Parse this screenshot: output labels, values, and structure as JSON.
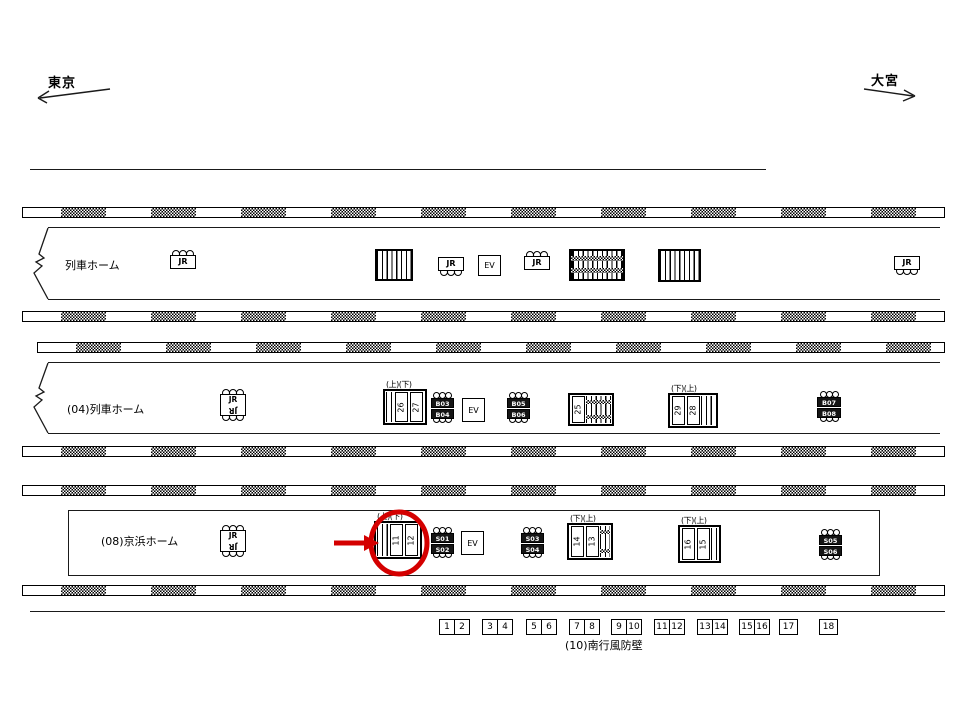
{
  "direction_labels": {
    "left": "東京",
    "right": "大宮"
  },
  "platforms": [
    {
      "name": "upper-platform",
      "label": "列車ホーム",
      "items": [
        {
          "type": "jr",
          "variant": "top",
          "label": "JR",
          "x": 170,
          "y": 250,
          "w": 26,
          "h": 22
        },
        {
          "type": "stairs",
          "x": 375,
          "y": 249,
          "w": 38,
          "h": 32
        },
        {
          "type": "jr",
          "variant": "bottom",
          "label": "JR",
          "x": 438,
          "y": 257,
          "w": 26,
          "h": 22
        },
        {
          "type": "ev",
          "label": "EV",
          "x": 478,
          "y": 255,
          "w": 23,
          "h": 21
        },
        {
          "type": "jr",
          "variant": "top",
          "label": "JR",
          "x": 524,
          "y": 251,
          "w": 26,
          "h": 22
        },
        {
          "type": "escalator",
          "x": 569,
          "y": 249,
          "w": 56,
          "h": 32
        },
        {
          "type": "stairs",
          "x": 658,
          "y": 249,
          "w": 43,
          "h": 33
        },
        {
          "type": "jr",
          "variant": "bottom",
          "label": "JR",
          "x": 894,
          "y": 256,
          "w": 26,
          "h": 22
        }
      ]
    },
    {
      "name": "platform-04",
      "label": "(04)列車ホーム",
      "items": [
        {
          "type": "jr",
          "variant": "double",
          "label": "JR",
          "x": 220,
          "y": 389,
          "w": 26,
          "h": 34
        },
        {
          "type": "num_structure",
          "header": "(上)(下)",
          "lines": "left",
          "numbers": [
            "26",
            "27"
          ],
          "x": 383,
          "y": 389,
          "w": 44,
          "h": 36
        },
        {
          "type": "sign2",
          "labels": [
            "B03",
            "B04"
          ],
          "x": 431,
          "y": 392,
          "w": 23,
          "h": 30
        },
        {
          "type": "ev",
          "label": "EV",
          "x": 462,
          "y": 398,
          "w": 23,
          "h": 24
        },
        {
          "type": "sign2",
          "labels": [
            "B05",
            "B06"
          ],
          "x": 507,
          "y": 392,
          "w": 23,
          "h": 30
        },
        {
          "type": "esc_structure",
          "header": "",
          "numbers": [
            "25"
          ],
          "x": 568,
          "y": 393,
          "w": 46,
          "h": 33
        },
        {
          "type": "num_structure",
          "header": "(下)(上)",
          "lines": "right",
          "numbers": [
            "29",
            "28"
          ],
          "x": 668,
          "y": 393,
          "w": 50,
          "h": 35
        },
        {
          "type": "sign2",
          "labels": [
            "B07",
            "B08"
          ],
          "x": 817,
          "y": 391,
          "w": 24,
          "h": 30
        }
      ]
    },
    {
      "name": "platform-08-keihin",
      "label": "(08)京浜ホーム",
      "items": [
        {
          "type": "jr",
          "variant": "double",
          "label": "JR",
          "x": 220,
          "y": 525,
          "w": 26,
          "h": 34
        },
        {
          "type": "num_structure",
          "header": "(上)(下)",
          "lines": "left",
          "numbers": [
            "11",
            "12"
          ],
          "x": 374,
          "y": 521,
          "w": 48,
          "h": 38
        },
        {
          "type": "sign2",
          "labels": [
            "S01",
            "S02"
          ],
          "x": 431,
          "y": 527,
          "w": 23,
          "h": 30
        },
        {
          "type": "ev",
          "label": "EV",
          "x": 461,
          "y": 531,
          "w": 23,
          "h": 24
        },
        {
          "type": "sign2",
          "labels": [
            "S03",
            "S04"
          ],
          "x": 521,
          "y": 527,
          "w": 23,
          "h": 30
        },
        {
          "type": "esc_structure",
          "header": "(下)(上)",
          "numbers": [
            "14",
            "13"
          ],
          "x": 567,
          "y": 523,
          "w": 46,
          "h": 37
        },
        {
          "type": "num_structure",
          "header": "(下)(上)",
          "lines": "right",
          "numbers": [
            "16",
            "15"
          ],
          "x": 678,
          "y": 525,
          "w": 43,
          "h": 38
        },
        {
          "type": "sign2",
          "labels": [
            "S05",
            "S06"
          ],
          "x": 819,
          "y": 529,
          "w": 23,
          "h": 30
        }
      ]
    }
  ],
  "bottom_wall": {
    "label": "(10)南行風防壁",
    "pairs": [
      [
        "1",
        "2"
      ],
      [
        "3",
        "4"
      ],
      [
        "5",
        "6"
      ],
      [
        "7",
        "8"
      ],
      [
        "9",
        "10"
      ],
      [
        "11",
        "12"
      ],
      [
        "13",
        "14"
      ],
      [
        "15",
        "16"
      ],
      [
        "17"
      ],
      [
        "18"
      ]
    ]
  },
  "annotations": {
    "color": "#d40000",
    "circle": {
      "cx": 399,
      "cy": 543,
      "rx": 28,
      "ry": 31
    },
    "arrow": {
      "x1": 334,
      "y1": 543,
      "x2": 366,
      "y2": 543,
      "tip_x": 379
    }
  }
}
